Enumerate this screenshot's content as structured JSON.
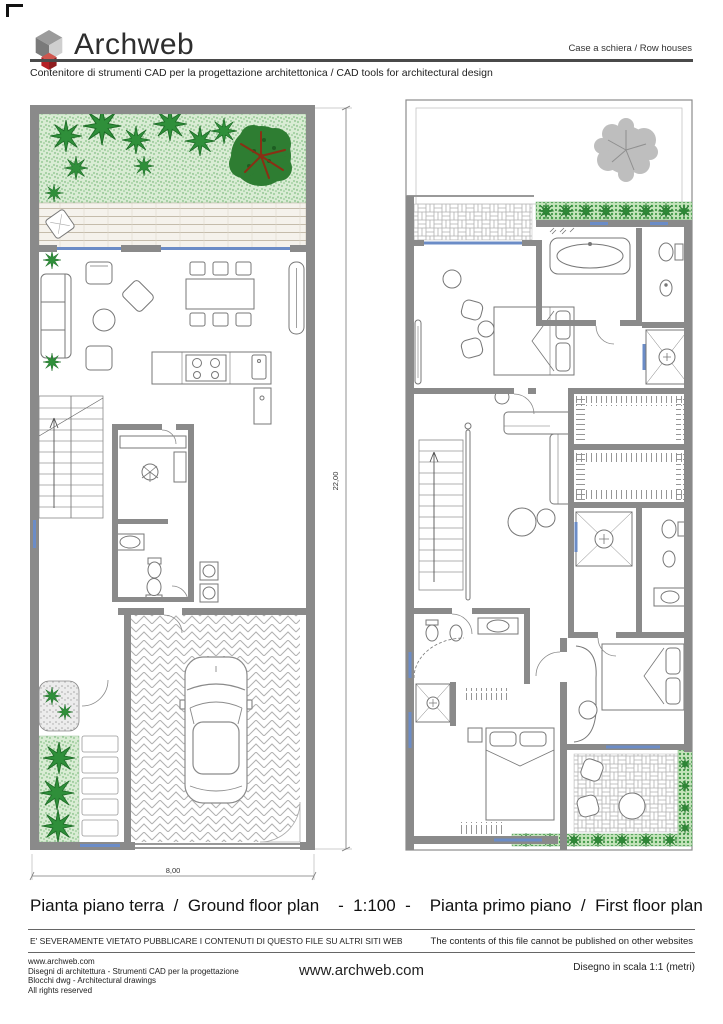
{
  "header": {
    "brand": "Archweb",
    "category": "Case a schiera  /  Row houses",
    "tagline": "Contenitore di strumenti CAD per la progettazione architettonica  /  CAD tools for architectural design"
  },
  "plans": {
    "ground": {
      "label_it": "Pianta piano terra",
      "label_en": "Ground floor plan",
      "dim_height": "22,00",
      "dim_width": "8,00"
    },
    "first": {
      "label_it": "Pianta primo piano",
      "label_en": "First floor plan"
    },
    "scale": "1:100"
  },
  "caption": "Pianta piano terra  /  Ground floor plan    -  1:100  -    Pianta primo piano  /  First floor plan",
  "notice": {
    "it": "E' SEVERAMENTE VIETATO PUBBLICARE I CONTENUTI DI QUESTO FILE SU ALTRI SITI WEB",
    "en": "The contents of this file cannot be published on other websites"
  },
  "footer": {
    "left_lines": [
      "www.archweb.com",
      "Disegni di architettura - Strumenti CAD  per la progettazione",
      "Blocchi dwg - Architectural drawings",
      "All rights reserved"
    ],
    "center_url": "www.archweb.com",
    "right_note": "Disegno in scala 1:1 (metri)"
  },
  "colors": {
    "wall_grey": "#8a8a8a",
    "garden_green": "#d9ecd4",
    "hedge_green": "#c4e4bb",
    "plant_green": "#2f8f3a",
    "tree_green": "#2e7d32",
    "tree_branch_red": "#8a2f14",
    "window_blue": "#6b8cc7",
    "logo_red": "#b52025",
    "rule_dark": "#4a4a4a"
  },
  "icons": {
    "logo": "archweb-cube-logo"
  }
}
